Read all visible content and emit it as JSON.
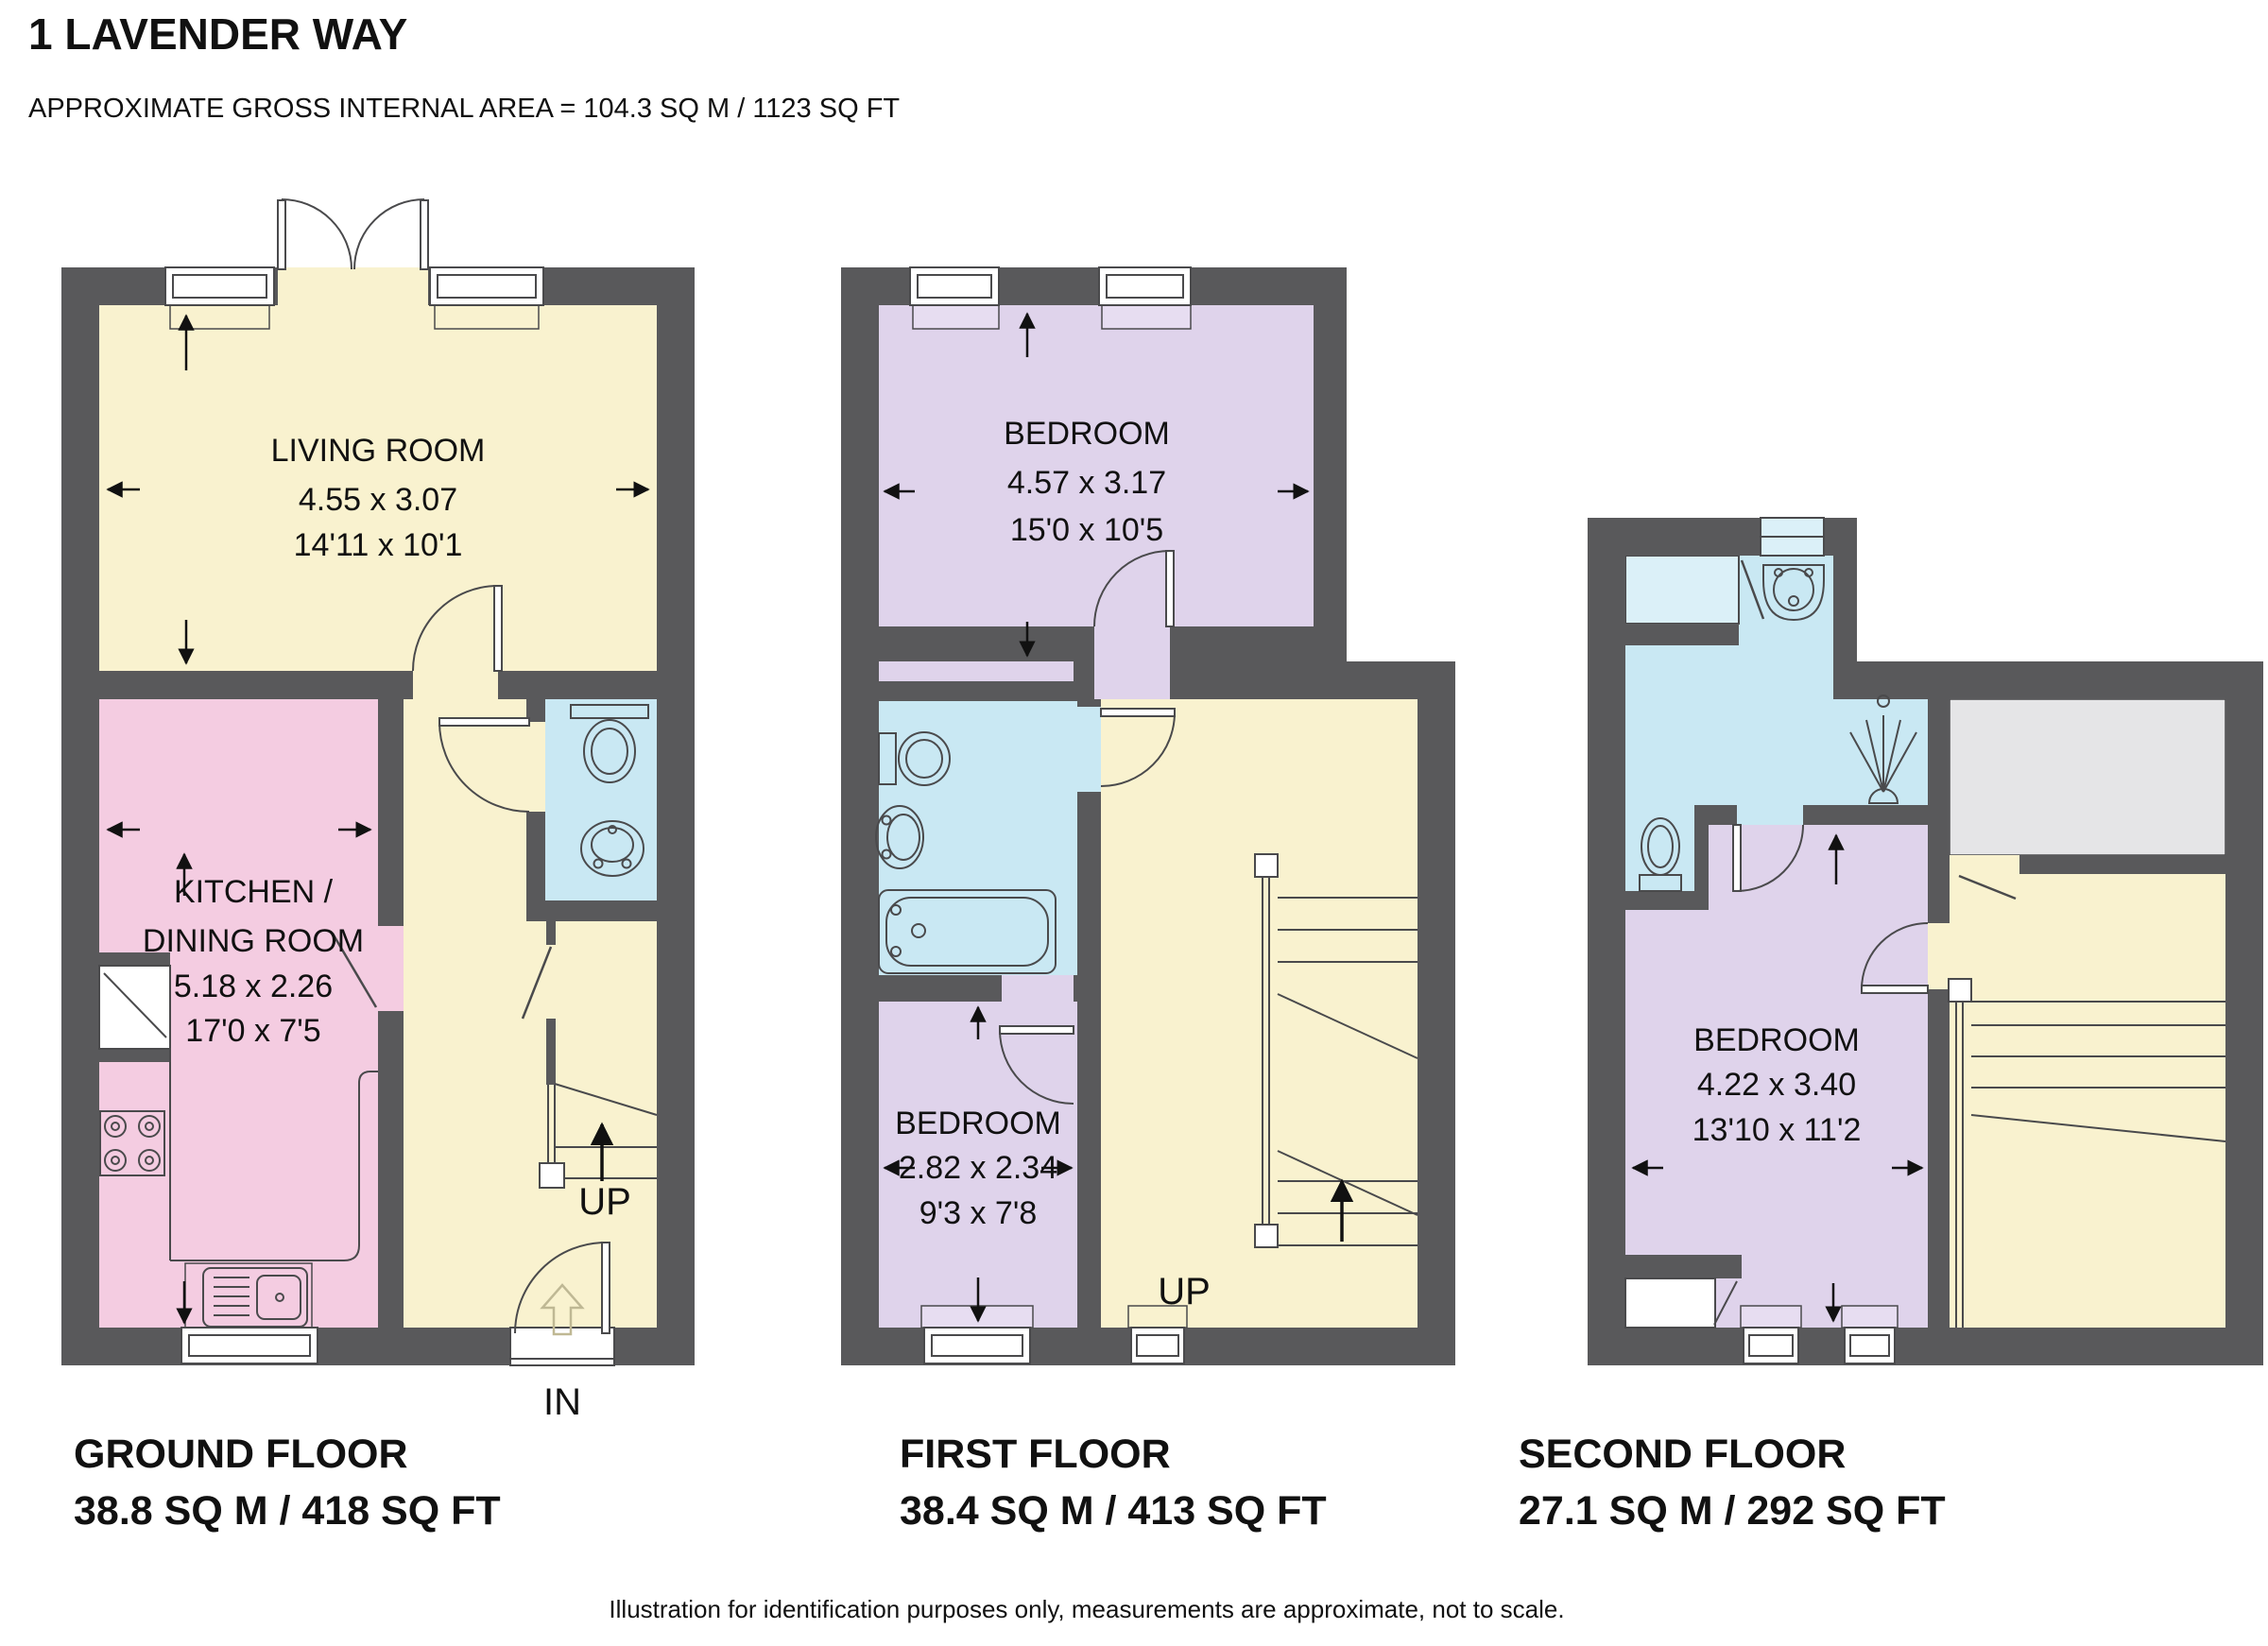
{
  "title": "1 LAVENDER WAY",
  "subtitle": "APPROXIMATE GROSS INTERNAL AREA = 104.3 SQ M / 1123 SQ FT",
  "footer": "Illustration for identification purposes only, measurements are approximate, not to scale.",
  "colors": {
    "wall": "#59595B",
    "living_hall": "#F9F2CF",
    "kitchen": "#F4CCE1",
    "bathroom": "#C9E8F3",
    "bedroom": "#DFD3EB",
    "storage": "#E5E5E7"
  },
  "floors": [
    {
      "name": "GROUND FLOOR",
      "area": "38.8 SQ M / 418 SQ FT",
      "stairs_label": "UP",
      "entrance_label": "IN",
      "rooms": [
        {
          "name": "LIVING ROOM",
          "dim_m": "4.55 x 3.07",
          "dim_ft": "14'11 x 10'1"
        },
        {
          "name": "KITCHEN /",
          "name2": "DINING ROOM",
          "dim_m": "5.18 x 2.26",
          "dim_ft": "17'0 x 7'5"
        }
      ]
    },
    {
      "name": "FIRST FLOOR",
      "area": "38.4 SQ M / 413 SQ FT",
      "stairs_label": "UP",
      "rooms": [
        {
          "name": "BEDROOM",
          "dim_m": "4.57 x 3.17",
          "dim_ft": "15'0 x 10'5"
        },
        {
          "name": "BEDROOM",
          "dim_m": "2.82 x 2.34",
          "dim_ft": "9'3 x 7'8"
        }
      ]
    },
    {
      "name": "SECOND FLOOR",
      "area": "27.1 SQ M / 292 SQ FT",
      "rooms": [
        {
          "name": "BEDROOM",
          "dim_m": "4.22 x 3.40",
          "dim_ft": "13'10 x 11'2"
        }
      ]
    }
  ]
}
